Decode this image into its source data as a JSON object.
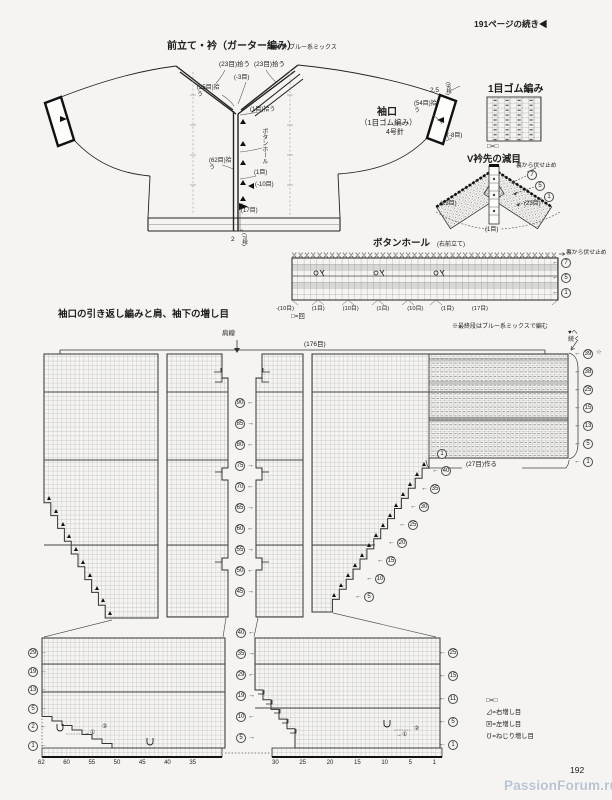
{
  "page": {
    "continued_header": "191ページの続き◀",
    "number": "192",
    "watermark": "PassionForum.ru"
  },
  "schematic": {
    "title": "前立て・衿（ガーター編み）",
    "title_note": "5号針 ブルー系ミックス",
    "pickup_neck_left": "(23目)拾う",
    "pickup_neck_right": "(23目)拾う",
    "dec_neck": "(-3目)",
    "pickup_25": "(25目)拾う",
    "pickup_1": "(1目)拾う",
    "buttonhole": "ボタンホール",
    "buttonhole_count": "(1目)",
    "pickup_62": "(62目)拾う",
    "dec_10": "(-10目)",
    "sts_17": "(17目)",
    "hem_width": "2",
    "hem_rows": "(7段)",
    "cuff_title": "袖口",
    "cuff_stitch": "（1目ゴム編み）",
    "cuff_needle": "4号針",
    "pickup_54": "(54目)拾う",
    "dec_8": "(-8目)",
    "cuff_width": "2.5",
    "cuff_rows": "(9段)"
  },
  "rib_chart": {
    "title": "1目ゴム編み",
    "legend": "□=□"
  },
  "vneck_chart": {
    "title": "V衿先の減目",
    "bindoff_note": "裏から伏せ止め",
    "rows": [
      "7",
      "5",
      "1"
    ],
    "left_sts": "(23目)",
    "right_sts": "(23目)",
    "center_st": "(1目)"
  },
  "buttonhole_chart": {
    "title": "ボタンホール",
    "subtitle": "(右前立て)",
    "bindoff_note": "裏から伏せ止め",
    "rows": [
      "7",
      "5",
      "1"
    ],
    "span_labels": [
      "-(10目)",
      "(1目)",
      "(10目)",
      "(1目)",
      "(10目)",
      "(1目)",
      "(17目)"
    ],
    "legend": "□=回"
  },
  "main_chart": {
    "title": "袖口の引き返し編みと肩、袖下の増し目",
    "color_note": "※最終段はブルー系ミックスで編む",
    "continue_note": "♥へ続く",
    "shoulder_line": "肩線",
    "cast_on_total": "(176目)",
    "cast_on_27": "(27目)作る",
    "final_row_star": "☆",
    "strip_first_row": "1",
    "center_rows": [
      "90",
      "85",
      "80",
      "75",
      "70",
      "65",
      "60",
      "55",
      "50",
      "45"
    ],
    "right_rows": [
      "39",
      "38",
      "25",
      "15",
      "13",
      "5",
      "1"
    ],
    "sleeve_slope_rows": [
      "40",
      "35",
      "30",
      "25",
      "20",
      "15",
      "10",
      "5"
    ]
  },
  "lower_chart": {
    "left_rows": [
      "29",
      "19",
      "13",
      "5",
      "2",
      "1"
    ],
    "center_rows": [
      "40",
      "35",
      "29",
      "19",
      "10",
      "5"
    ],
    "right_rows": [
      "25",
      "15",
      "11",
      "5",
      "1"
    ],
    "left_axis": [
      "62",
      "60",
      "55",
      "50",
      "45",
      "40",
      "35"
    ],
    "right_axis": [
      "30",
      "25",
      "20",
      "15",
      "10",
      "5",
      "1"
    ],
    "inc_note_1": "→①",
    "inc_note_2": "②",
    "inc_note_3": "→①",
    "inc_note_4": "②"
  },
  "legend": {
    "items": [
      "□=□",
      "⊿=右増し目",
      "⊠=左増し目",
      "℧=ねじり増し目"
    ]
  }
}
